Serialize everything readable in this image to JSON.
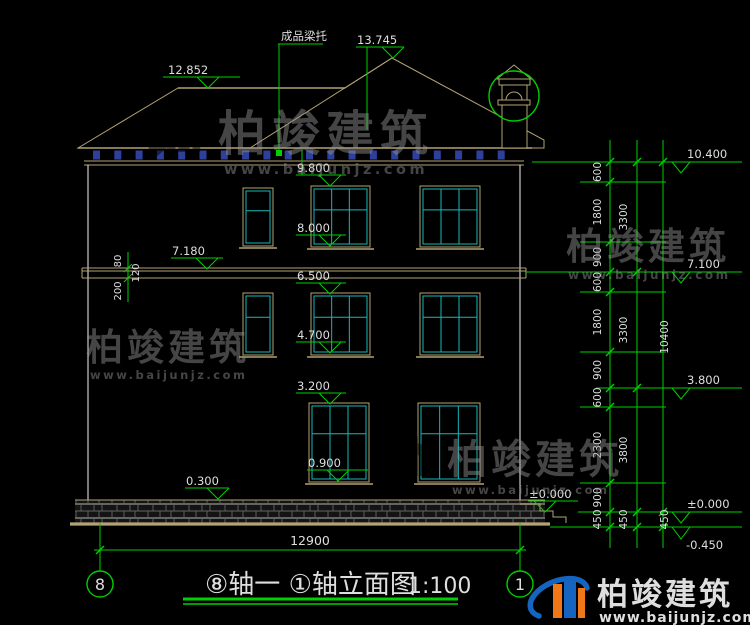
{
  "drawing": {
    "title": "⑧轴一 ①轴立面图",
    "scale": "1:100",
    "axis_left": "8",
    "axis_right": "1",
    "roof_note": "成品梁托",
    "total_width": "12900"
  },
  "elevations": {
    "ridge_high": "13.745",
    "ridge_main": "12.852",
    "f3_head": "9.800",
    "f3_sill": "8.000",
    "belt": "7.180",
    "f2_head": "6.500",
    "f2_sill": "4.700",
    "f1_head": "3.200",
    "f1_sill": "0.900",
    "plinth": "0.300",
    "steps_zero": "±0.000",
    "right_top": "10.400",
    "right_f3": "7.100",
    "right_f2": "3.800",
    "right_zero": "±0.000",
    "right_ground": "-0.450"
  },
  "band_dims": {
    "a": "80",
    "b": "120",
    "c": "200"
  },
  "right_chains": {
    "chain1": [
      "600",
      "1800",
      "900",
      "600",
      "1800",
      "900",
      "600",
      "2300",
      "900",
      "450"
    ],
    "chain2": [
      "3300",
      "3300",
      "3800",
      "450"
    ],
    "chain3": [
      "10400",
      "450"
    ]
  },
  "watermark": {
    "brand": "柏竣建筑",
    "url": "www.baijunjz.com"
  },
  "colors": {
    "green": "#00cf00",
    "white": "#dedede",
    "tan": "#b3a273",
    "cyan": "#16b8b8",
    "corbel": "#2e3f9c",
    "wm": "#979797",
    "logo_blue": "#1565c0",
    "logo_orange": "#f07818",
    "url_red": "#e03030"
  }
}
